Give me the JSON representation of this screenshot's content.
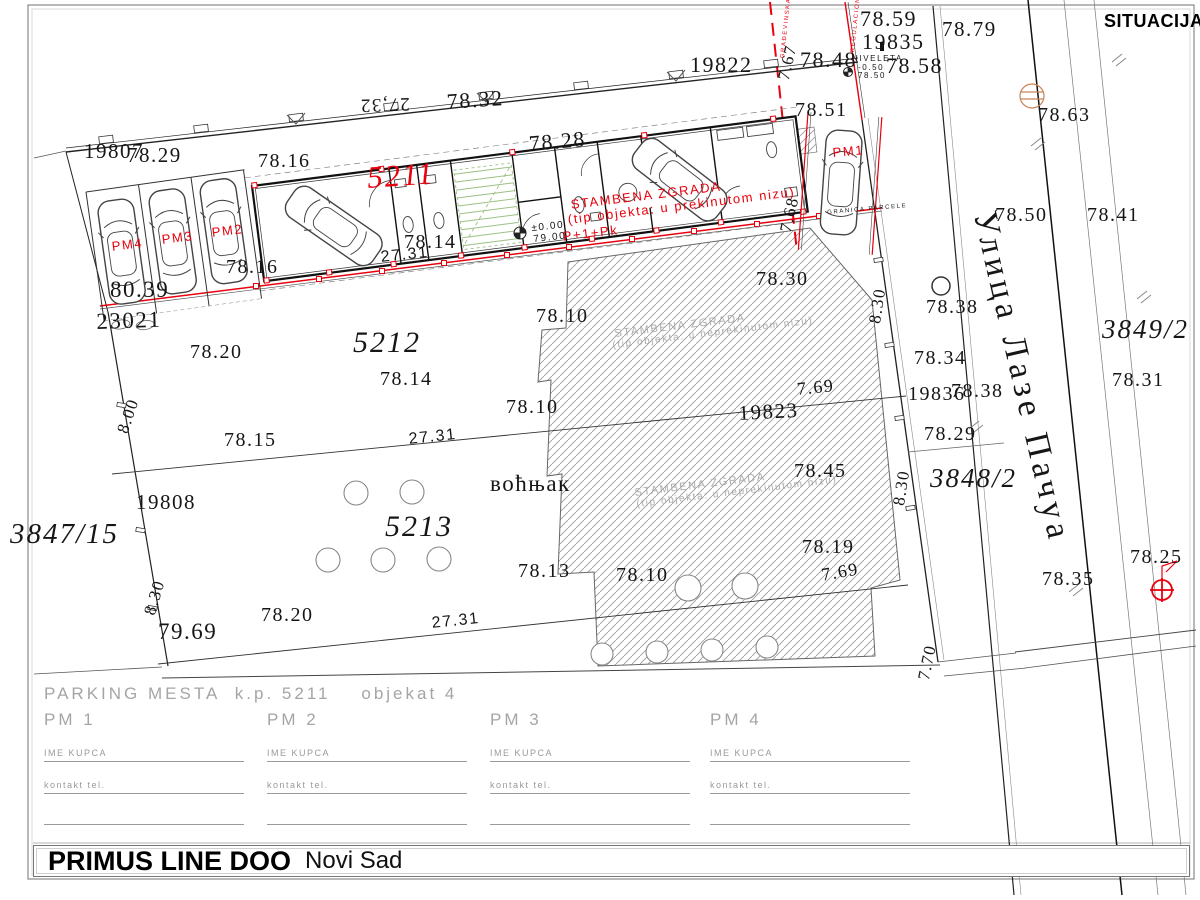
{
  "header": {
    "title": "SITUACIJA"
  },
  "street": {
    "name": "Улица Лазе Пачуа"
  },
  "footer": {
    "company": "PRIMUS LINE DOO",
    "city": "Novi Sad"
  },
  "parking_table": {
    "title": "PARKING MESTA  k.p. 5211    objekat 4",
    "columns": [
      {
        "slot": "PM 1",
        "buyer_label": "IME KUPCA",
        "phone_label": "kontakt tel."
      },
      {
        "slot": "PM 2",
        "buyer_label": "IME KUPCA",
        "phone_label": "kontakt tel."
      },
      {
        "slot": "PM 3",
        "buyer_label": "IME KUPCA",
        "phone_label": "kontakt tel."
      },
      {
        "slot": "PM 4",
        "buyer_label": "IME KUPCA",
        "phone_label": "kontakt tel."
      }
    ]
  },
  "colors": {
    "red": "#e8000d",
    "annotation_gray": "#ababab",
    "table_gray": "#9a9a9a",
    "stairs_green": "#9bc183",
    "orange": "#c8825a"
  },
  "plan_labels": [
    {
      "t": "78.59",
      "x": 860,
      "y": 8,
      "s": 22
    },
    {
      "t": "19835",
      "x": 862,
      "y": 31,
      "s": 22
    },
    {
      "t": "78.79",
      "x": 942,
      "y": 19,
      "s": 21
    },
    {
      "t": "19822",
      "x": 690,
      "y": 54,
      "s": 22
    },
    {
      "t": "7.67",
      "x": 775,
      "y": 78,
      "s": 17,
      "r": -77
    },
    {
      "t": "78.48",
      "x": 800,
      "y": 49,
      "s": 22
    },
    {
      "t": "78.58",
      "x": 886,
      "y": 55,
      "s": 22
    },
    {
      "t": "NIVELETA",
      "x": 852,
      "y": 55,
      "s": 8,
      "f": "cad"
    },
    {
      "t": "-0.50",
      "x": 858,
      "y": 64,
      "s": 8,
      "f": "cad"
    },
    {
      "t": "78.50",
      "x": 858,
      "y": 72,
      "s": 8,
      "f": "cad"
    },
    {
      "t": "78.51",
      "x": 795,
      "y": 100,
      "s": 20
    },
    {
      "t": "78.63",
      "x": 1038,
      "y": 105,
      "s": 20
    },
    {
      "t": "27,32",
      "x": 410,
      "y": 113,
      "s": 19,
      "r": 178
    },
    {
      "t": "78.32",
      "x": 446,
      "y": 91,
      "s": 22,
      "r": -4
    },
    {
      "t": "78.28",
      "x": 528,
      "y": 133,
      "s": 22,
      "r": -5
    },
    {
      "t": "19807",
      "x": 84,
      "y": 141,
      "s": 21
    },
    {
      "t": "78.29",
      "x": 127,
      "y": 145,
      "s": 21
    },
    {
      "t": "78.16",
      "x": 258,
      "y": 151,
      "s": 20
    },
    {
      "t": "5211",
      "x": 366,
      "y": 162,
      "s": 31,
      "f": "parcel",
      "c": "#e8000d",
      "r": -4
    },
    {
      "t": "78.14",
      "x": 404,
      "y": 232,
      "s": 20
    },
    {
      "t": "27.31",
      "x": 380,
      "y": 250,
      "s": 16,
      "f": "cad",
      "r": -6
    },
    {
      "t": "±0.00",
      "x": 531,
      "y": 224,
      "s": 10,
      "f": "cad",
      "r": -6
    },
    {
      "t": "79.00",
      "x": 533,
      "y": 235,
      "s": 10,
      "f": "cad",
      "r": -6
    },
    {
      "t": "STAMBENA ZGRADA",
      "x": 570,
      "y": 198,
      "s": 13,
      "c": "#e8000d",
      "f": "cad",
      "r": -7
    },
    {
      "t": "(tip objekta: u prekinutom nizu)",
      "x": 567,
      "y": 213,
      "s": 13,
      "c": "#e8000d",
      "f": "cad",
      "r": -7
    },
    {
      "t": "P+1+Pk",
      "x": 562,
      "y": 230,
      "s": 13,
      "c": "#e8000d",
      "f": "cad",
      "r": -7
    },
    {
      "t": "7.68",
      "x": 777,
      "y": 230,
      "s": 17,
      "r": -77
    },
    {
      "t": "GRANICA PARCELE",
      "x": 827,
      "y": 210,
      "s": 6,
      "f": "cad",
      "r": -5
    },
    {
      "t": "PM1",
      "x": 832,
      "y": 146,
      "s": 13,
      "c": "#e8000d",
      "f": "cad",
      "r": -5
    },
    {
      "t": "PM4",
      "x": 111,
      "y": 240,
      "s": 13,
      "c": "#e8000d",
      "f": "cad",
      "r": -7
    },
    {
      "t": "PM3",
      "x": 161,
      "y": 233,
      "s": 13,
      "c": "#e8000d",
      "f": "cad",
      "r": -7
    },
    {
      "t": "PM2",
      "x": 211,
      "y": 226,
      "s": 13,
      "c": "#e8000d",
      "f": "cad",
      "r": -7
    },
    {
      "t": "80.39",
      "x": 110,
      "y": 278,
      "s": 23
    },
    {
      "t": "78.16",
      "x": 226,
      "y": 257,
      "s": 20
    },
    {
      "t": "23021",
      "x": 96,
      "y": 310,
      "s": 23,
      "r": -2
    },
    {
      "t": "GRAĐEVINSKA LINIJA",
      "x": 780,
      "y": 58,
      "s": 6,
      "c": "#e8000d",
      "f": "cad",
      "r": -84
    },
    {
      "t": "REGULACIONA LINIJA",
      "x": 850,
      "y": 52,
      "s": 6,
      "c": "#e8000d",
      "f": "cad",
      "r": -84
    },
    {
      "t": "78.20",
      "x": 190,
      "y": 342,
      "s": 20
    },
    {
      "t": "5212",
      "x": 353,
      "y": 328,
      "s": 30,
      "f": "parcel"
    },
    {
      "t": "78.14",
      "x": 380,
      "y": 369,
      "s": 20
    },
    {
      "t": "78.15",
      "x": 224,
      "y": 430,
      "s": 20
    },
    {
      "t": "78.10",
      "x": 536,
      "y": 306,
      "s": 20
    },
    {
      "t": "78.10",
      "x": 506,
      "y": 397,
      "s": 20
    },
    {
      "t": "78.30",
      "x": 756,
      "y": 269,
      "s": 20
    },
    {
      "t": "STAMBENA ZGRADA",
      "x": 614,
      "y": 329,
      "s": 11,
      "c": "#ababab",
      "f": "cad",
      "r": -7
    },
    {
      "t": "(tip objekta: u neprekinutom nizu)",
      "x": 612,
      "y": 341,
      "s": 10,
      "c": "#ababab",
      "f": "cad",
      "r": -7
    },
    {
      "t": "7.69",
      "x": 796,
      "y": 380,
      "s": 18,
      "r": -6
    },
    {
      "t": "19823",
      "x": 738,
      "y": 403,
      "s": 21,
      "r": -3
    },
    {
      "t": "19836",
      "x": 908,
      "y": 384,
      "s": 20
    },
    {
      "t": "78.38",
      "x": 951,
      "y": 381,
      "s": 20
    },
    {
      "t": "78.34",
      "x": 914,
      "y": 348,
      "s": 20
    },
    {
      "t": "78.38",
      "x": 926,
      "y": 297,
      "s": 20
    },
    {
      "t": "78.29",
      "x": 924,
      "y": 424,
      "s": 20
    },
    {
      "t": "3848/2",
      "x": 930,
      "y": 465,
      "s": 27,
      "f": "parcel"
    },
    {
      "t": "8.30",
      "x": 866,
      "y": 322,
      "s": 17,
      "r": -81
    },
    {
      "t": "8.30",
      "x": 890,
      "y": 504,
      "s": 17,
      "r": -81
    },
    {
      "t": "78.45",
      "x": 794,
      "y": 461,
      "s": 20
    },
    {
      "t": "78.19",
      "x": 802,
      "y": 537,
      "s": 20
    },
    {
      "t": "7.69",
      "x": 820,
      "y": 566,
      "s": 18,
      "r": -10
    },
    {
      "t": "STAMBENA ZGRADA",
      "x": 634,
      "y": 488,
      "s": 11,
      "c": "#ababab",
      "f": "cad",
      "r": -7
    },
    {
      "t": "(tip objekta: u neprekinutom nizu)",
      "x": 636,
      "y": 500,
      "s": 10,
      "c": "#ababab",
      "f": "cad",
      "r": -7
    },
    {
      "t": "воћњак",
      "x": 490,
      "y": 472,
      "s": 23
    },
    {
      "t": "5213",
      "x": 385,
      "y": 512,
      "s": 30,
      "f": "parcel"
    },
    {
      "t": "78.13",
      "x": 518,
      "y": 561,
      "s": 20
    },
    {
      "t": "78.10",
      "x": 616,
      "y": 565,
      "s": 20
    },
    {
      "t": "78.20",
      "x": 261,
      "y": 605,
      "s": 20
    },
    {
      "t": "27.31",
      "x": 408,
      "y": 432,
      "s": 16,
      "f": "cad",
      "r": -6
    },
    {
      "t": "27.31",
      "x": 431,
      "y": 616,
      "s": 16,
      "f": "cad",
      "r": -6
    },
    {
      "t": "79.69",
      "x": 158,
      "y": 620,
      "s": 23
    },
    {
      "t": "8.30",
      "x": 141,
      "y": 612,
      "s": 17,
      "r": -73
    },
    {
      "t": "8.00",
      "x": 114,
      "y": 430,
      "s": 17,
      "r": -71
    },
    {
      "t": "19808",
      "x": 136,
      "y": 492,
      "s": 21
    },
    {
      "t": "3847/15",
      "x": 10,
      "y": 520,
      "s": 29,
      "f": "parcel"
    },
    {
      "t": "78.50",
      "x": 995,
      "y": 205,
      "s": 20
    },
    {
      "t": "78.41",
      "x": 1087,
      "y": 205,
      "s": 20
    },
    {
      "t": "3849/2",
      "x": 1102,
      "y": 316,
      "s": 27,
      "f": "parcel"
    },
    {
      "t": "78.31",
      "x": 1112,
      "y": 370,
      "s": 20
    },
    {
      "t": "78.35",
      "x": 1042,
      "y": 569,
      "s": 20
    },
    {
      "t": "78.25",
      "x": 1130,
      "y": 547,
      "s": 20
    },
    {
      "t": "7.70",
      "x": 915,
      "y": 678,
      "s": 17,
      "r": -78
    },
    {
      "t": "Улица Лазе Пачуа",
      "x": 1000,
      "y": 208,
      "s": 34,
      "f": "street",
      "r": 77
    }
  ]
}
